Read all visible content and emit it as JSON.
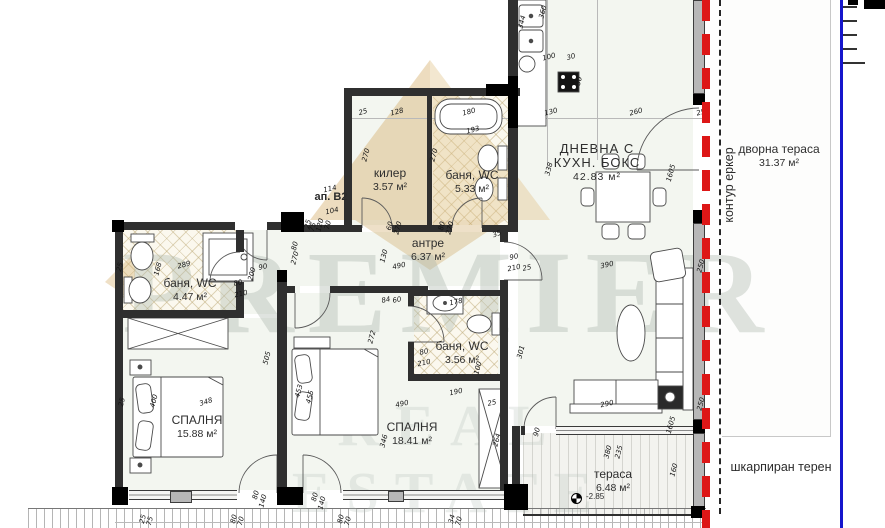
{
  "plan": {
    "apartment_label": "ап. В2",
    "rooms": [
      {
        "id": "living",
        "name": "ДНЕВНА С",
        "name2": "КУХН. БОКС",
        "area": "42.83 м²"
      },
      {
        "id": "pantry",
        "name": "килер",
        "area": "3.57 м²"
      },
      {
        "id": "bath1",
        "name": "баня, WC",
        "area": "5.33 м²"
      },
      {
        "id": "hall",
        "name": "антре",
        "area": "6.37 м²"
      },
      {
        "id": "bath2",
        "name": "баня, WC",
        "area": "4.47 м²"
      },
      {
        "id": "bath3",
        "name": "баня, WC",
        "area": "3.56 м²"
      },
      {
        "id": "bedroom1",
        "name": "СПАЛНЯ",
        "area": "15.88 м²"
      },
      {
        "id": "bedroom2",
        "name": "СПАЛНЯ",
        "area": "18.41 м²"
      },
      {
        "id": "terrace",
        "name": "тераса",
        "area": "6.48 м²"
      },
      {
        "id": "yard",
        "name": "дворна тераса",
        "area": "31.37 м²"
      }
    ],
    "annotations": {
      "bay_contour": "контур еркер",
      "terrain": "шкарпиран терен",
      "elevation": "-2.85"
    },
    "dimensions": [
      {
        "t": "25",
        "x": 363,
        "y": 112,
        "r": -15
      },
      {
        "t": "128",
        "x": 397,
        "y": 112,
        "r": -15
      },
      {
        "t": "180",
        "x": 469,
        "y": 112,
        "r": -15
      },
      {
        "t": "193",
        "x": 473,
        "y": 130,
        "r": -15
      },
      {
        "t": "130",
        "x": 551,
        "y": 112,
        "r": -15
      },
      {
        "t": "260",
        "x": 636,
        "y": 112,
        "r": -15
      },
      {
        "t": "250",
        "x": 703,
        "y": 112,
        "r": -15
      },
      {
        "t": "344",
        "x": 522,
        "y": 22,
        "r": -75
      },
      {
        "t": "360",
        "x": 543,
        "y": 12,
        "r": -75
      },
      {
        "t": "100",
        "x": 549,
        "y": 57,
        "r": -15
      },
      {
        "t": "30",
        "x": 571,
        "y": 57,
        "r": -15
      },
      {
        "t": "50",
        "x": 579,
        "y": 81,
        "r": -75
      },
      {
        "t": "338",
        "x": 549,
        "y": 169,
        "r": -75
      },
      {
        "t": "1605",
        "x": 671,
        "y": 173,
        "r": -75
      },
      {
        "t": "270",
        "x": 366,
        "y": 155,
        "r": -75
      },
      {
        "t": "270",
        "x": 434,
        "y": 155,
        "r": -75
      },
      {
        "t": "60",
        "x": 390,
        "y": 226,
        "r": -75
      },
      {
        "t": "270",
        "x": 398,
        "y": 228,
        "r": -75
      },
      {
        "t": "80",
        "x": 442,
        "y": 226,
        "r": -75
      },
      {
        "t": "270",
        "x": 450,
        "y": 228,
        "r": -75
      },
      {
        "t": "35",
        "x": 497,
        "y": 234,
        "r": -20
      },
      {
        "t": "114",
        "x": 330,
        "y": 189,
        "r": -12
      },
      {
        "t": "104",
        "x": 332,
        "y": 211,
        "r": -12
      },
      {
        "t": "25",
        "x": 308,
        "y": 224,
        "r": -75
      },
      {
        "t": "75",
        "x": 313,
        "y": 227,
        "r": -75
      },
      {
        "t": "120",
        "x": 320,
        "y": 225,
        "r": -75
      },
      {
        "t": "70",
        "x": 328,
        "y": 225,
        "r": -75
      },
      {
        "t": "80",
        "x": 295,
        "y": 246,
        "r": -75
      },
      {
        "t": "270",
        "x": 295,
        "y": 258,
        "r": -75
      },
      {
        "t": "25",
        "x": 120,
        "y": 267,
        "r": -75
      },
      {
        "t": "168",
        "x": 158,
        "y": 269,
        "r": -75
      },
      {
        "t": "289",
        "x": 184,
        "y": 265,
        "r": -15
      },
      {
        "t": "80",
        "x": 238,
        "y": 283,
        "r": -12
      },
      {
        "t": "210",
        "x": 241,
        "y": 294,
        "r": -12
      },
      {
        "t": "200",
        "x": 252,
        "y": 274,
        "r": -75
      },
      {
        "t": "90",
        "x": 263,
        "y": 267,
        "r": -12
      },
      {
        "t": "490",
        "x": 399,
        "y": 266,
        "r": -12
      },
      {
        "t": "130",
        "x": 384,
        "y": 256,
        "r": -75
      },
      {
        "t": "90",
        "x": 514,
        "y": 257,
        "r": -12
      },
      {
        "t": "210",
        "x": 514,
        "y": 268,
        "r": -12
      },
      {
        "t": "25",
        "x": 527,
        "y": 268,
        "r": -12
      },
      {
        "t": "84",
        "x": 386,
        "y": 300,
        "r": -12
      },
      {
        "t": "60",
        "x": 397,
        "y": 300,
        "r": -12
      },
      {
        "t": "178",
        "x": 456,
        "y": 302,
        "r": -12
      },
      {
        "t": "80",
        "x": 424,
        "y": 352,
        "r": -12
      },
      {
        "t": "210",
        "x": 424,
        "y": 363,
        "r": -12
      },
      {
        "t": "100",
        "x": 478,
        "y": 368,
        "r": -75
      },
      {
        "t": "190",
        "x": 456,
        "y": 392,
        "r": -12
      },
      {
        "t": "25",
        "x": 492,
        "y": 403,
        "r": -12
      },
      {
        "t": "272",
        "x": 372,
        "y": 337,
        "r": -75
      },
      {
        "t": "301",
        "x": 521,
        "y": 352,
        "r": -75
      },
      {
        "t": "490",
        "x": 402,
        "y": 404,
        "r": -12
      },
      {
        "t": "346",
        "x": 384,
        "y": 441,
        "r": -75
      },
      {
        "t": "453",
        "x": 299,
        "y": 391,
        "r": -75
      },
      {
        "t": "455",
        "x": 310,
        "y": 397,
        "r": -75
      },
      {
        "t": "505",
        "x": 267,
        "y": 358,
        "r": -75
      },
      {
        "t": "264",
        "x": 497,
        "y": 440,
        "r": -75
      },
      {
        "t": "348",
        "x": 206,
        "y": 402,
        "r": -18
      },
      {
        "t": "400",
        "x": 154,
        "y": 401,
        "r": -75
      },
      {
        "t": "25",
        "x": 122,
        "y": 402,
        "r": -75
      },
      {
        "t": "390",
        "x": 607,
        "y": 265,
        "r": -12
      },
      {
        "t": "250",
        "x": 701,
        "y": 266,
        "r": -75
      },
      {
        "t": "290",
        "x": 607,
        "y": 404,
        "r": -12
      },
      {
        "t": "250",
        "x": 701,
        "y": 404,
        "r": -75
      },
      {
        "t": "1605",
        "x": 671,
        "y": 425,
        "r": -75
      },
      {
        "t": "160",
        "x": 674,
        "y": 470,
        "r": -75
      },
      {
        "t": "380",
        "x": 608,
        "y": 452,
        "r": -75
      },
      {
        "t": "235",
        "x": 619,
        "y": 452,
        "r": -75
      },
      {
        "t": "90",
        "x": 537,
        "y": 432,
        "r": -75
      },
      {
        "t": "25",
        "x": 143,
        "y": 519,
        "r": -75
      },
      {
        "t": "75",
        "x": 150,
        "y": 521,
        "r": -75
      },
      {
        "t": "80",
        "x": 234,
        "y": 519,
        "r": -75
      },
      {
        "t": "70",
        "x": 241,
        "y": 521,
        "r": -75
      },
      {
        "t": "80",
        "x": 341,
        "y": 519,
        "r": -75
      },
      {
        "t": "70",
        "x": 348,
        "y": 521,
        "r": -75
      },
      {
        "t": "34",
        "x": 452,
        "y": 519,
        "r": -75
      },
      {
        "t": "70",
        "x": 459,
        "y": 521,
        "r": -75
      },
      {
        "t": "80",
        "x": 256,
        "y": 495,
        "r": -75
      },
      {
        "t": "140",
        "x": 263,
        "y": 501,
        "r": -75
      },
      {
        "t": "80",
        "x": 315,
        "y": 497,
        "r": -75
      },
      {
        "t": "140",
        "x": 322,
        "y": 503,
        "r": -75
      }
    ]
  },
  "watermark": {
    "line1": "PREMIER",
    "line2": "REAL ESTATE"
  },
  "colors": {
    "bay_window_line": "#dd1717",
    "plot_boundary_line": "#1616cc",
    "contour_dash_line": "#262626",
    "wall": "#2f2f2f",
    "watermark_gold": "#d4ab66"
  }
}
